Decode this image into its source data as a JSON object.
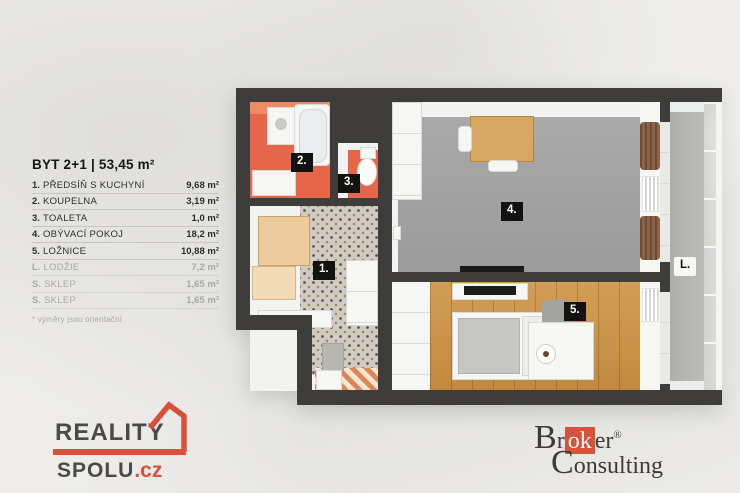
{
  "legend": {
    "title": "BYT 2+1 | 53,45 m²",
    "rows": [
      {
        "num": "1.",
        "name": "PŘEDSÍŇ S KUCHYNÍ",
        "area": "9,68 m²"
      },
      {
        "num": "2.",
        "name": "KOUPELNA",
        "area": "3,19 m²"
      },
      {
        "num": "3.",
        "name": "TOALETA",
        "area": "1,0 m²"
      },
      {
        "num": "4.",
        "name": "OBÝVACÍ POKOJ",
        "area": "18,2 m²"
      },
      {
        "num": "5.",
        "name": "LOŽNICE",
        "area": "10,88 m²"
      },
      {
        "num": "L.",
        "name": "LODŽIE",
        "area": "7,2 m²"
      },
      {
        "num": "S.",
        "name": "SKLEP",
        "area": "1,65 m²"
      },
      {
        "num": "S.",
        "name": "SKLEP",
        "area": "1,65 m²"
      }
    ],
    "footnote": "* výměry jsou orientační"
  },
  "floorplan": {
    "labels": [
      {
        "text": "1."
      },
      {
        "text": "2."
      },
      {
        "text": "3."
      },
      {
        "text": "4."
      },
      {
        "text": "5."
      },
      {
        "text": "L."
      }
    ]
  },
  "logos": {
    "reality_spolu": {
      "word1": "REALITY",
      "word2": "SPOLU",
      "tld": ".cz"
    },
    "broker_consulting": {
      "cap1": "B",
      "pre": "r",
      "highlight": "ok",
      "post": "er",
      "registered": "®",
      "cap2": "C",
      "rest": "onsulting"
    }
  },
  "colors": {
    "accent_red": "#d8503a",
    "wall_dark": "#3e3d3b",
    "bathroom_orange": "#e5664a",
    "bedroom_wood": "#cd9243",
    "living_gray": "#a2a2a2",
    "muted_text": "#a9a8a6"
  }
}
